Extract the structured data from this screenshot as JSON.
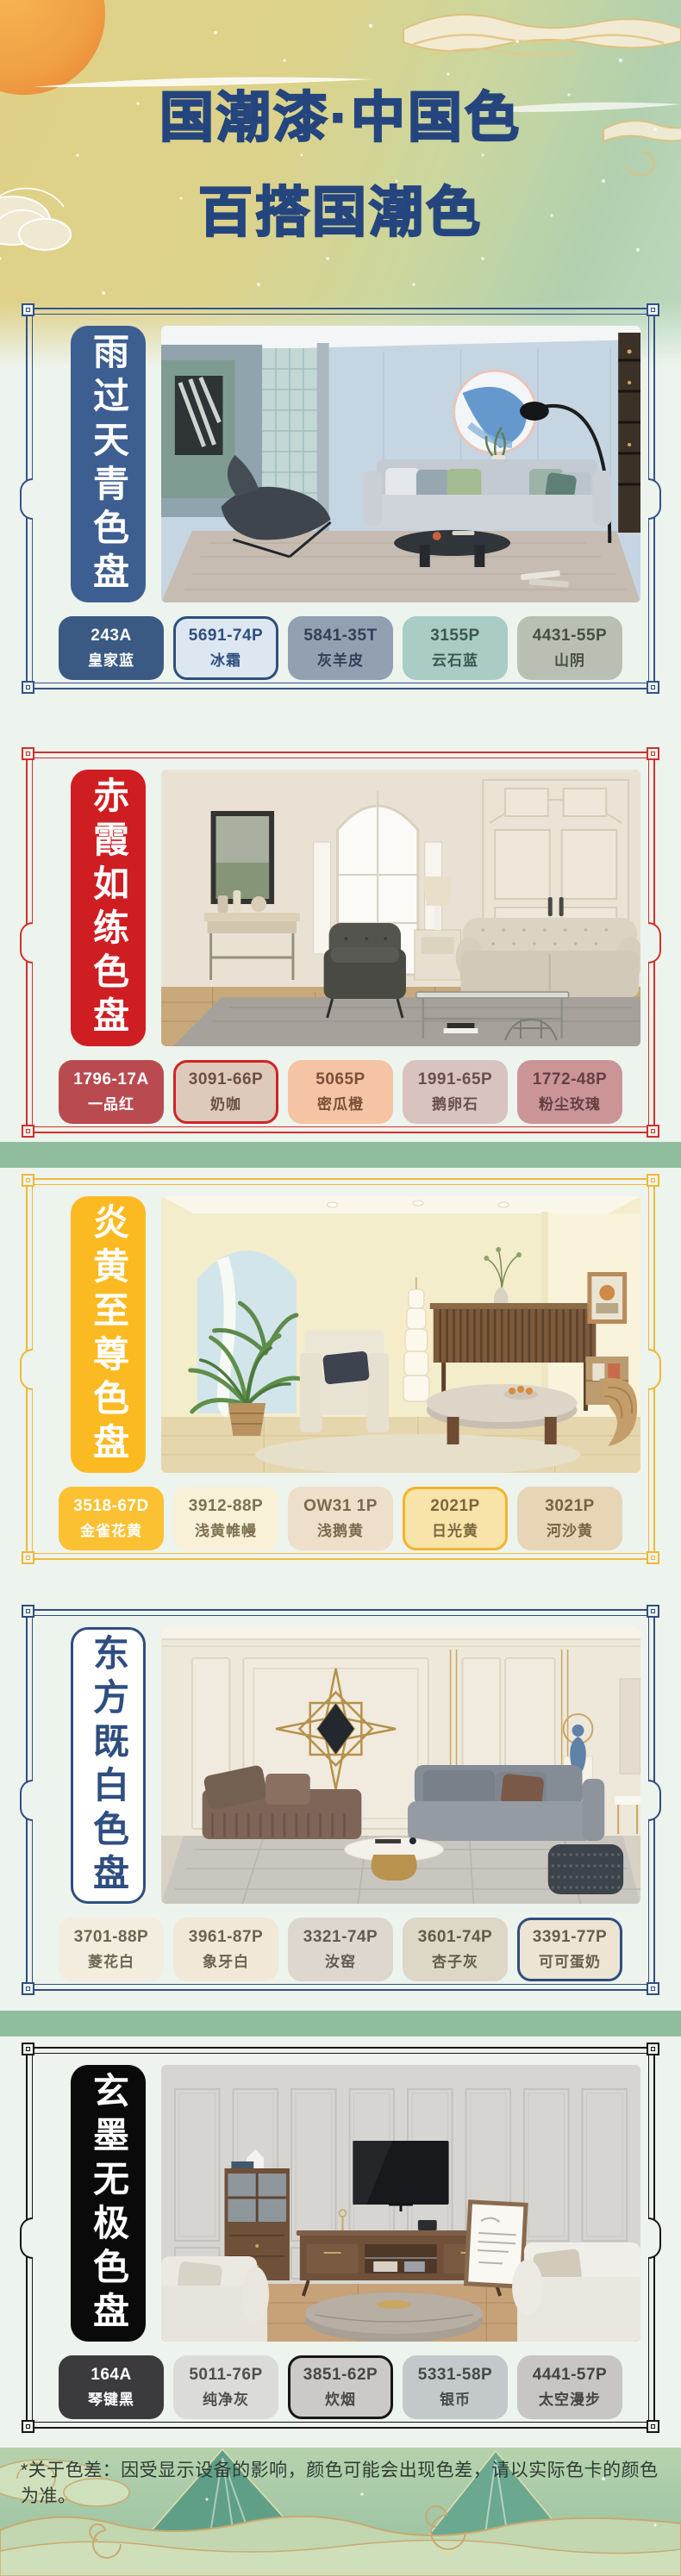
{
  "header": {
    "title_line1": "国潮漆·中国色",
    "title_line2": "百搭国潮色",
    "title_color": "#24457d"
  },
  "decor": {
    "band_color": "#8fbd9e"
  },
  "footer": {
    "note": "*关于色差：因受显示设备的影响，颜色可能会出现色差，请以实际色卡的颜色为准。"
  },
  "sections": [
    {
      "name": "雨过天青色盘",
      "frame_color": "#33518a",
      "banner_bg": "#3d5e90",
      "banner_text": "#ffffff",
      "banner_border": "transparent",
      "swatches": [
        {
          "code": "243A",
          "label": "皇家蓝",
          "bg": "#3a5a84",
          "text": "#ffffff",
          "border": "transparent"
        },
        {
          "code": "5691-74P",
          "label": "冰霜",
          "bg": "#dce7f2",
          "text": "#2f4e7d",
          "border": "#2f4e7d"
        },
        {
          "code": "5841-35T",
          "label": "灰羊皮",
          "bg": "#93a0b1",
          "text": "#323f58",
          "border": "transparent"
        },
        {
          "code": "3155P",
          "label": "云石蓝",
          "bg": "#a9ccc5",
          "text": "#3c5752",
          "border": "transparent"
        },
        {
          "code": "4431-55P",
          "label": "山阴",
          "bg": "#b9bfb2",
          "text": "#485042",
          "border": "transparent"
        }
      ]
    },
    {
      "name": "赤霞如练色盘",
      "frame_color": "#d2302c",
      "banner_bg": "#cf1e22",
      "banner_text": "#ffffff",
      "banner_border": "transparent",
      "swatches": [
        {
          "code": "1796-17A",
          "label": "一品红",
          "bg": "#b94b50",
          "text": "#ffffff",
          "border": "transparent"
        },
        {
          "code": "3091-66P",
          "label": "奶咖",
          "bg": "#ddcabb",
          "text": "#6d4f41",
          "border": "#cf2424"
        },
        {
          "code": "5065P",
          "label": "密瓜橙",
          "bg": "#f5c4a4",
          "text": "#7a4f38",
          "border": "transparent"
        },
        {
          "code": "1991-65P",
          "label": "鹅卵石",
          "bg": "#d8c3c1",
          "text": "#6b4f4a",
          "border": "transparent"
        },
        {
          "code": "1772-48P",
          "label": "粉尘玫瑰",
          "bg": "#cb9598",
          "text": "#643f43",
          "border": "transparent"
        }
      ]
    },
    {
      "name": "炎黄至尊色盘",
      "frame_color": "#f0b838",
      "banner_bg": "#fcba22",
      "banner_text": "#ffffff",
      "banner_border": "transparent",
      "swatches": [
        {
          "code": "3518-67D",
          "label": "金雀花黄",
          "bg": "#fbc133",
          "text": "#ffffff",
          "border": "transparent"
        },
        {
          "code": "3912-88P",
          "label": "浅黄帷幔",
          "bg": "#f8f1d8",
          "text": "#7c7050",
          "border": "transparent"
        },
        {
          "code": "OW31 1P",
          "label": "浅鹅黄",
          "bg": "#eddfc9",
          "text": "#7a6a4e",
          "border": "transparent"
        },
        {
          "code": "2021P",
          "label": "日光黄",
          "bg": "#f8e3a8",
          "text": "#7a6740",
          "border": "#f2b42c"
        },
        {
          "code": "3021P",
          "label": "河沙黄",
          "bg": "#e7d5b5",
          "text": "#776243",
          "border": "transparent"
        }
      ]
    },
    {
      "name": "东方既白色盘",
      "frame_color": "#2f4e80",
      "banner_bg": "#ffffff",
      "banner_text": "#2f4e80",
      "banner_border": "#2f4e80",
      "swatches": [
        {
          "code": "3701-88P",
          "label": "菱花白",
          "bg": "#f2eddf",
          "text": "#6b6552",
          "border": "transparent"
        },
        {
          "code": "3961-87P",
          "label": "象牙白",
          "bg": "#f0e9d7",
          "text": "#6b6450",
          "border": "transparent"
        },
        {
          "code": "3321-74P",
          "label": "汝窑",
          "bg": "#ded7d0",
          "text": "#615a52",
          "border": "transparent"
        },
        {
          "code": "3601-74P",
          "label": "杏子灰",
          "bg": "#dcd7c6",
          "text": "#5f5c48",
          "border": "transparent"
        },
        {
          "code": "3391-77P",
          "label": "可可蛋奶",
          "bg": "#ede4d3",
          "text": "#675f4c",
          "border": "#2f4e80"
        }
      ]
    },
    {
      "name": "玄墨无极色盘",
      "frame_color": "#161616",
      "banner_bg": "#0a0a0a",
      "banner_text": "#ffffff",
      "banner_border": "transparent",
      "swatches": [
        {
          "code": "164A",
          "label": "琴键黑",
          "bg": "#3b3b3d",
          "text": "#ffffff",
          "border": "transparent"
        },
        {
          "code": "5011-76P",
          "label": "纯净灰",
          "bg": "#dbdbd9",
          "text": "#4f4f4d",
          "border": "transparent"
        },
        {
          "code": "3851-62P",
          "label": "炊烟",
          "bg": "#cbcac6",
          "text": "#474745",
          "border": "#161616"
        },
        {
          "code": "5331-58P",
          "label": "银币",
          "bg": "#c3c9cb",
          "text": "#45494b",
          "border": "transparent"
        },
        {
          "code": "4441-57P",
          "label": "太空漫步",
          "bg": "#c8c6c2",
          "text": "#454442",
          "border": "transparent"
        }
      ]
    }
  ]
}
